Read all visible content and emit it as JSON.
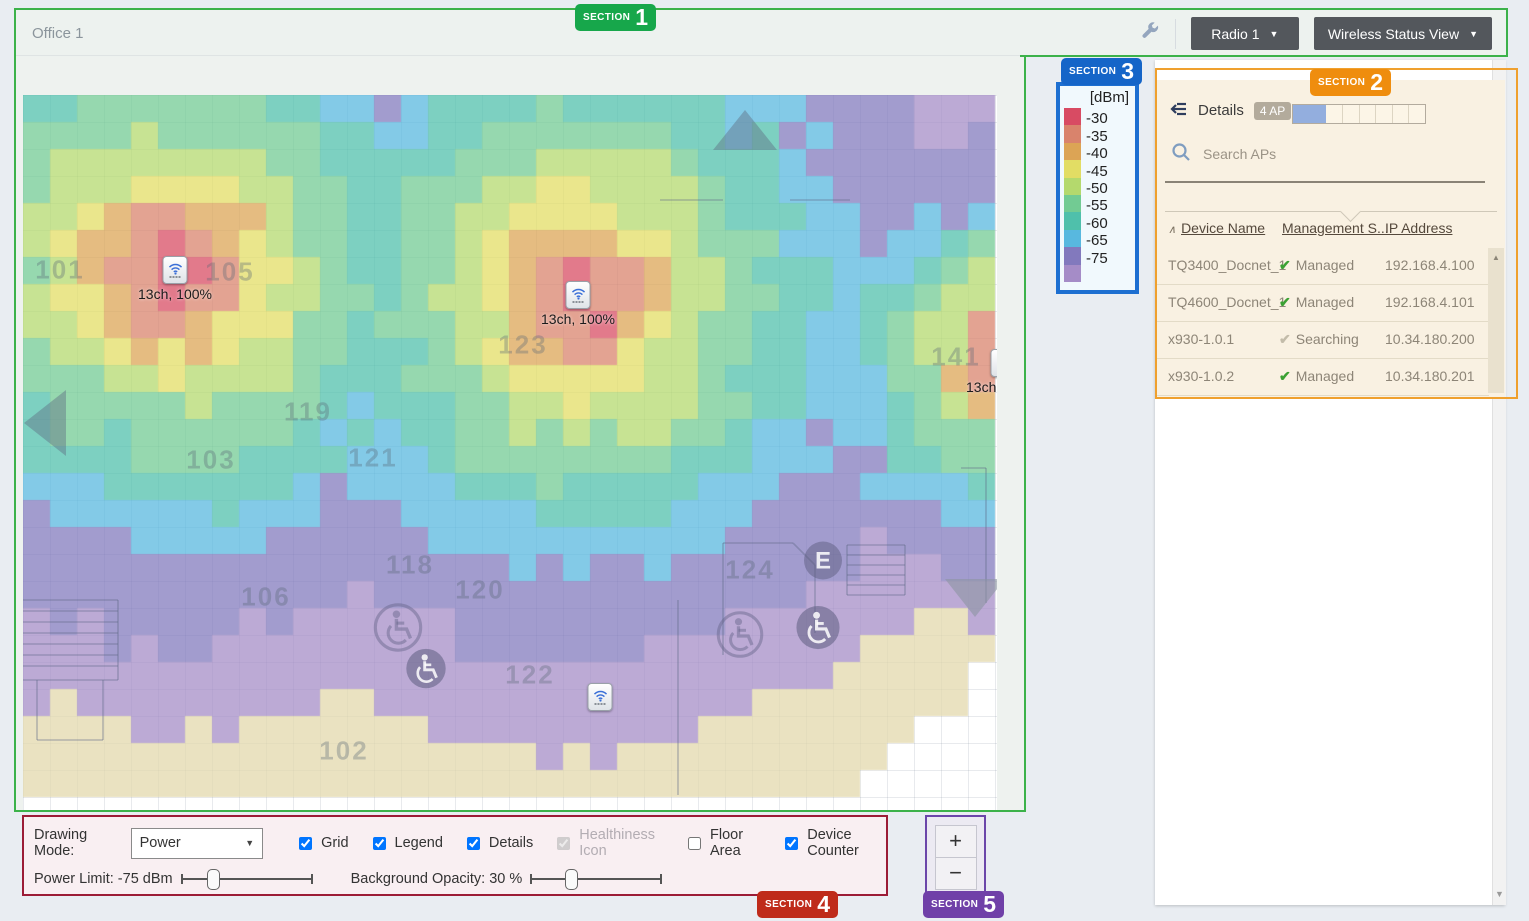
{
  "header": {
    "title": "Office 1",
    "wrench_icon": "wrench-icon",
    "radio_label": "Radio 1",
    "view_label": "Wireless Status View",
    "caret": "▼"
  },
  "sections": [
    {
      "label": "SECTION",
      "num": "1",
      "color": "#17a74b"
    },
    {
      "label": "SECTION",
      "num": "2",
      "color": "#ef8d0e"
    },
    {
      "label": "SECTION",
      "num": "3",
      "color": "#1565c8"
    },
    {
      "label": "SECTION",
      "num": "4",
      "color": "#bf2b1a"
    },
    {
      "label": "SECTION",
      "num": "5",
      "color": "#7040a8"
    }
  ],
  "legend": {
    "title": "[dBm]",
    "entries": [
      {
        "label": "-30",
        "color": "#d84b63"
      },
      {
        "label": "-35",
        "color": "#d9836c"
      },
      {
        "label": "-40",
        "color": "#dca455"
      },
      {
        "label": "-45",
        "color": "#e2dd64"
      },
      {
        "label": "-50",
        "color": "#b4d96d"
      },
      {
        "label": "-55",
        "color": "#72cb93"
      },
      {
        "label": "-60",
        "color": "#4fc0ab"
      },
      {
        "label": "-65",
        "color": "#58b8df"
      },
      {
        "label": "-75",
        "color": "#8279bd"
      },
      {
        "label": "",
        "color": "#a58cc7"
      }
    ]
  },
  "details": {
    "title": "Details",
    "count_badge": "4 AP",
    "capacity_segments": 8,
    "capacity_filled": 2,
    "capacity_fill_color": "#93aede",
    "search_placeholder": "Search APs",
    "sort_icon": "∧",
    "columns": [
      "Device Name",
      "Management S...",
      "IP Address"
    ],
    "rows": [
      {
        "name": "TQ3400_Docnet_1",
        "status": "Managed",
        "managed": true,
        "ip": "192.168.4.100"
      },
      {
        "name": "TQ4600_Docnet_1",
        "status": "Managed",
        "managed": true,
        "ip": "192.168.4.101"
      },
      {
        "name": "x930-1.0.1",
        "status": "Searching",
        "managed": false,
        "ip": "10.34.180.200"
      },
      {
        "name": "x930-1.0.2",
        "status": "Managed",
        "managed": true,
        "ip": "10.34.180.201"
      }
    ],
    "status_check_color": "#3ba133",
    "status_searching_color": "#c3bcaa"
  },
  "map": {
    "rooms": [
      {
        "t": "101",
        "x": 37,
        "y": 175
      },
      {
        "t": "105",
        "x": 207,
        "y": 177
      },
      {
        "t": "123",
        "x": 500,
        "y": 250
      },
      {
        "t": "119",
        "x": 285,
        "y": 317
      },
      {
        "t": "103",
        "x": 188,
        "y": 365
      },
      {
        "t": "121",
        "x": 350,
        "y": 363
      },
      {
        "t": "141",
        "x": 933,
        "y": 262
      },
      {
        "t": "118",
        "x": 387,
        "y": 470
      },
      {
        "t": "120",
        "x": 457,
        "y": 495
      },
      {
        "t": "106",
        "x": 243,
        "y": 502
      },
      {
        "t": "124",
        "x": 727,
        "y": 475
      },
      {
        "t": "122",
        "x": 507,
        "y": 580
      },
      {
        "t": "102",
        "x": 321,
        "y": 656
      }
    ],
    "aps": [
      {
        "x": 152,
        "y": 175,
        "label": "13ch, 100%"
      },
      {
        "x": 555,
        "y": 200,
        "label": "13ch, 100%"
      },
      {
        "x": 980,
        "y": 268,
        "label": "13ch, 100%"
      },
      {
        "x": 577,
        "y": 602,
        "label": ""
      }
    ],
    "icons": [
      {
        "type": "wheelchair",
        "variant": "outline",
        "x": 375,
        "y": 535,
        "r": 25
      },
      {
        "type": "wheelchair",
        "variant": "filled",
        "x": 403,
        "y": 576,
        "r": 21
      },
      {
        "type": "wheelchair",
        "variant": "outline",
        "x": 717,
        "y": 542,
        "r": 24
      },
      {
        "type": "wheelchair",
        "variant": "filled",
        "x": 795,
        "y": 535,
        "r": 23
      },
      {
        "type": "elevator",
        "label": "E",
        "x": 800,
        "y": 468,
        "r": 20
      },
      {
        "type": "triangle-up",
        "x": 722,
        "y": 35
      },
      {
        "type": "triangle-left",
        "x": 22,
        "y": 328
      },
      {
        "type": "triangle-down",
        "x": 952,
        "y": 503
      }
    ],
    "walls": [
      [
        637,
        105,
        700,
        105
      ],
      [
        767,
        105,
        827,
        105
      ],
      [
        0,
        505,
        95,
        505
      ],
      [
        95,
        505,
        95,
        585
      ],
      [
        0,
        585,
        95,
        585
      ],
      [
        0,
        516,
        95,
        516
      ],
      [
        0,
        527,
        95,
        527
      ],
      [
        0,
        538,
        95,
        538
      ],
      [
        0,
        549,
        95,
        549
      ],
      [
        0,
        560,
        95,
        560
      ],
      [
        0,
        571,
        95,
        571
      ],
      [
        14,
        585,
        14,
        645
      ],
      [
        80,
        585,
        80,
        645
      ],
      [
        14,
        645,
        80,
        645
      ],
      [
        824,
        450,
        882,
        450
      ],
      [
        882,
        450,
        882,
        500
      ],
      [
        824,
        500,
        882,
        500
      ],
      [
        824,
        450,
        824,
        500
      ],
      [
        824,
        460,
        882,
        460
      ],
      [
        824,
        470,
        882,
        470
      ],
      [
        824,
        480,
        882,
        480
      ],
      [
        824,
        490,
        882,
        490
      ],
      [
        700,
        448,
        770,
        448
      ],
      [
        770,
        448,
        792,
        470
      ],
      [
        792,
        470,
        792,
        538
      ],
      [
        700,
        448,
        700,
        560
      ],
      [
        963,
        373,
        963,
        508
      ],
      [
        938,
        373,
        963,
        373
      ],
      [
        655,
        505,
        655,
        700
      ]
    ],
    "heatmap": {
      "cell_px": 27,
      "cols": 36,
      "rows": 26,
      "opacity": 0.74,
      "noise": 1.3,
      "aps": [
        {
          "cx": 5.63,
          "cy": 6.5,
          "p0": -24,
          "s1": 5.5,
          "s2": 3.0,
          "brk": 4,
          "stretch": 1
        },
        {
          "cx": 20.6,
          "cy": 7.4,
          "p0": -24,
          "s1": 5.5,
          "s2": 3.0,
          "brk": 4,
          "stretch": 1
        },
        {
          "cx": 36.3,
          "cy": 9.93,
          "p0": -23,
          "s1": 5.5,
          "s2": 3.0,
          "brk": 4,
          "stretch": 1.75
        }
      ],
      "thresholds": [
        [
          -30,
          "#d84b63"
        ],
        [
          -35,
          "#d9836c"
        ],
        [
          -40,
          "#dca455"
        ],
        [
          -45,
          "#e2dd64"
        ],
        [
          -50,
          "#b4d96d"
        ],
        [
          -55,
          "#72cb93"
        ],
        [
          -60,
          "#4fc0ab"
        ],
        [
          -65,
          "#58b8df"
        ],
        [
          -75,
          "#8279bd"
        ],
        [
          -85,
          "#a58cc7"
        ],
        [
          -95,
          "#e3d8ab"
        ]
      ]
    }
  },
  "controls": {
    "mode_label": "Drawing Mode:",
    "mode_value": "Power",
    "caret": "▼",
    "checkboxes": [
      {
        "label": "Grid",
        "checked": true,
        "disabled": false
      },
      {
        "label": "Legend",
        "checked": true,
        "disabled": false
      },
      {
        "label": "Details",
        "checked": true,
        "disabled": false
      },
      {
        "label": "Healthiness Icon",
        "checked": true,
        "disabled": true
      },
      {
        "label": "Floor Area",
        "checked": false,
        "disabled": false
      },
      {
        "label": "Device Counter",
        "checked": true,
        "disabled": false
      }
    ],
    "sliders": [
      {
        "label": "Power Limit: -75 dBm",
        "pos": 0.22
      },
      {
        "label": "Background Opacity: 30 %",
        "pos": 0.3
      }
    ]
  },
  "zoom_controls": {
    "plus": "+",
    "minus": "−"
  },
  "scrollbars": {
    "up_arrow": "▲",
    "down_arrow": "▼"
  }
}
